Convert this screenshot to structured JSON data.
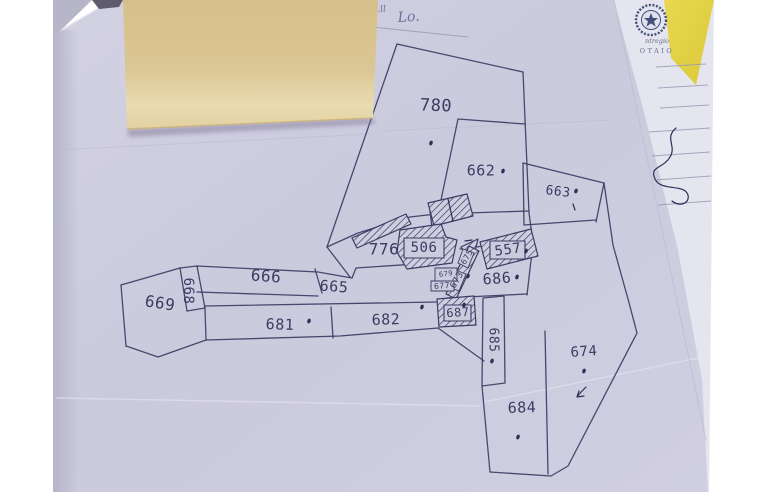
{
  "photo": {
    "background": "#ffffff",
    "paper": "#cccbdd",
    "paper_light": "#d8d7e7",
    "paper_shadow": "#b6b5c9",
    "note_color": "#d9c28e",
    "note_light": "#eadcB0",
    "folder_yellow": "#e4d244",
    "letterhead_paper": "#e5e5f0",
    "ink": "#3c3c63",
    "ink_text": "#2f2f58",
    "handwriting_ink": "#67709a"
  },
  "letterhead": {
    "emblem": "italian-republic-emblem",
    "line1": "ntregio",
    "line2": "OTAIO",
    "rule_lines": [
      "656,67 706,64",
      "658,88 708,85",
      "660,108 709,105",
      "649,132 710,128",
      "652,156 710,152",
      "655,180 711,176",
      "658,205 711,201"
    ],
    "signature_squiggle": "M676,128 C664,138 677,146 670,157 C663,169 649,166 655,179 C661,192 684,183 688,195 C690,204 679,207 672,201"
  },
  "handwriting": {
    "fragment": "ecc.ll",
    "word": "Lo."
  },
  "map": {
    "parcel_numbers": [
      "780",
      "662",
      "663",
      "776",
      "506",
      "557",
      "666",
      "665",
      "668",
      "669",
      "681",
      "682",
      "687",
      "686",
      "685",
      "684",
      "674",
      "675",
      "673",
      "679",
      "677"
    ],
    "boundaries": [
      "397,44 523,72",
      "523,72 529,213 533,243 527,295",
      "397,44 327,247 350,277",
      "458,119 525,124",
      "458,119 441,200 436,214",
      "436,214 529,211",
      "436,214 410,217 358,233 327,247",
      "523,163 524,225",
      "523,163 604,183",
      "604,183 596,222",
      "524,225 596,220",
      "604,183 613,245 628,299 637,333 568,466 551,476 490,472",
      "490,472 482,386",
      "545,331 548,474",
      "483,298 504,296 505,383 482,386 483,298",
      "460,249 531,240",
      "447,298 527,294",
      "121,285 180,268 197,266 318,272 352,278",
      "315,269 322,293",
      "197,292 318,296",
      "180,268 187,311",
      "197,266 205,308",
      "121,285 126,346",
      "126,346 158,357 206,340",
      "187,311 205,308",
      "205,306 437,302",
      "206,340 340,336 438,328",
      "331,307 333,338",
      "205,308 206,340",
      "438,328 484,361",
      "352,278 356,268 431,263",
      "430,211 432,228"
    ],
    "buildings": [
      {
        "points": "352,238 406,214 411,224 357,248",
        "fill": "hatch"
      },
      {
        "points": "428,203 467,194 473,216 434,226",
        "fill": "hatch"
      },
      {
        "points": "400,230 441,224 446,237 457,240 452,263 407,269 397,252",
        "fill": "hatch"
      },
      {
        "points": "480,242 531,229 538,256 487,269",
        "fill": "hatch"
      },
      {
        "points": "461,247 478,239 472,263",
        "fill": "hatch"
      },
      {
        "points": "469,246 479,251 456,299 446,294",
        "fill": "hatch"
      },
      {
        "points": "437,299 474,296 476,325 439,327",
        "fill": "hatch"
      },
      {
        "points": "404,238 444,238 444,258 404,258",
        "fill": "paperbox"
      },
      {
        "points": "490,241 525,241 525,259 490,259",
        "fill": "paperbox"
      },
      {
        "points": "444,305 471,305 471,321 444,321",
        "fill": "paperbox"
      },
      {
        "points": "463,249 474,253 468,268 458,263",
        "fill": "paperbox2"
      },
      {
        "points": "455,270 466,274 459,291 449,287",
        "fill": "paperbox2"
      },
      {
        "points": "435,268 457,268 457,281 435,281",
        "fill": "paperbox2"
      },
      {
        "points": "431,281 454,281 454,291 431,291",
        "fill": "paperbox2"
      }
    ],
    "labels": [
      {
        "t": "780",
        "x": 436,
        "y": 106,
        "s": 17,
        "r": 2
      },
      {
        "t": "662",
        "x": 481,
        "y": 171,
        "s": 15,
        "r": 0
      },
      {
        "t": "663",
        "x": 558,
        "y": 192,
        "s": 13,
        "r": 7
      },
      {
        "t": "776",
        "x": 384,
        "y": 250,
        "s": 16,
        "r": 0
      },
      {
        "t": "506",
        "x": 424,
        "y": 248,
        "s": 14,
        "r": 0
      },
      {
        "t": "557",
        "x": 508,
        "y": 250,
        "s": 14,
        "r": -8
      },
      {
        "t": "666",
        "x": 266,
        "y": 277,
        "s": 16,
        "r": 4
      },
      {
        "t": "665",
        "x": 334,
        "y": 287,
        "s": 15,
        "r": 4
      },
      {
        "t": "668",
        "x": 188,
        "y": 291,
        "s": 14,
        "r": 90
      },
      {
        "t": "669",
        "x": 160,
        "y": 304,
        "s": 16,
        "r": 9
      },
      {
        "t": "681",
        "x": 280,
        "y": 325,
        "s": 15,
        "r": 2
      },
      {
        "t": "682",
        "x": 386,
        "y": 320,
        "s": 15,
        "r": -2
      },
      {
        "t": "687",
        "x": 458,
        "y": 313,
        "s": 12,
        "r": -4
      },
      {
        "t": "686",
        "x": 497,
        "y": 279,
        "s": 15,
        "r": -4
      },
      {
        "t": "685",
        "x": 493,
        "y": 340,
        "s": 13,
        "r": 90
      },
      {
        "t": "684",
        "x": 522,
        "y": 408,
        "s": 15,
        "r": -2
      },
      {
        "t": "674",
        "x": 584,
        "y": 352,
        "s": 14,
        "r": -4
      },
      {
        "t": "675",
        "x": 467,
        "y": 257,
        "s": 8,
        "r": -60
      },
      {
        "t": "673",
        "x": 457,
        "y": 280,
        "s": 9,
        "r": -60
      },
      {
        "t": "679",
        "x": 446,
        "y": 274,
        "s": 7,
        "r": -8
      },
      {
        "t": "677",
        "x": 442,
        "y": 286,
        "s": 8,
        "r": -4
      }
    ],
    "dots": [
      {
        "x": 431,
        "y": 143
      },
      {
        "x": 503,
        "y": 171
      },
      {
        "x": 576,
        "y": 191
      },
      {
        "x": 517,
        "y": 277
      },
      {
        "x": 526,
        "y": 251
      },
      {
        "x": 309,
        "y": 321
      },
      {
        "x": 422,
        "y": 307
      },
      {
        "x": 464,
        "y": 305
      },
      {
        "x": 492,
        "y": 361
      },
      {
        "x": 518,
        "y": 437
      },
      {
        "x": 584,
        "y": 371
      },
      {
        "x": 468,
        "y": 276
      }
    ],
    "marks": [
      "M465,241 L472,240",
      "M448,199 L453,221",
      "M573,204 L575,210",
      "M586,387 C582,391 579,394 577,397 M577,397 L584,396 M577,397 L579,391"
    ],
    "creases": [
      "58,150 370,134",
      "380,131 612,120"
    ],
    "creases_light": [
      "56,398 480,406",
      "484,402 708,356"
    ]
  }
}
